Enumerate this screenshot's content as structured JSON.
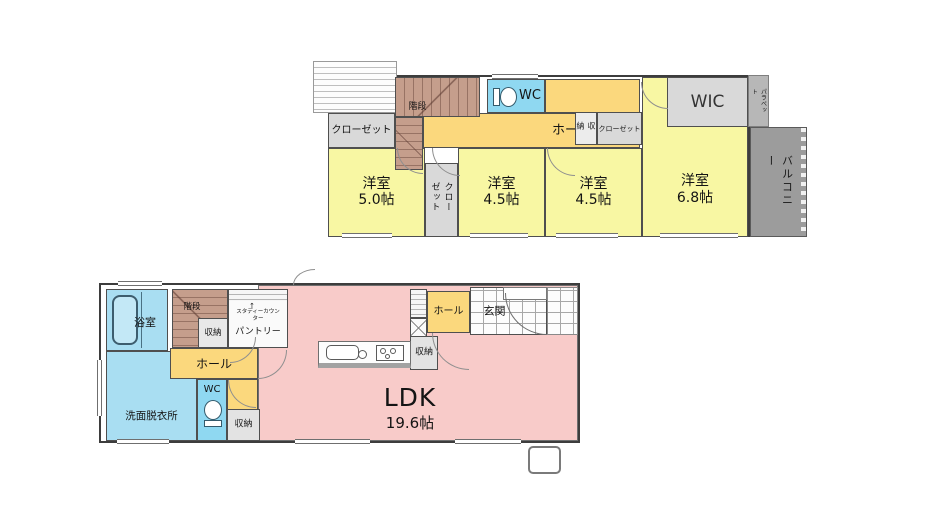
{
  "colors": {
    "room_yellow": "#f8f7a3",
    "hall_orange": "#fbd87d",
    "bath_blue": "#a9def2",
    "wc_blue": "#8fd8f1",
    "stairs_brown": "#c59e8c",
    "closet_gray": "#d9d9d9",
    "parapet_gray": "#b7b7b7",
    "balcony_gray": "#9c9c9c",
    "ldk_pink": "#f8cbc9",
    "wall_dark": "#3d3d3d"
  },
  "floor2": {
    "stairs": "階段",
    "wc": "WC",
    "hall": "ホール",
    "closet_left": "クローゼット",
    "closet_vert": "クローゼット",
    "storage": "収納",
    "closet_mid": "クローゼット",
    "wic": "WIC",
    "parapet": "パラペット",
    "balcony": "バルコニー",
    "rooms": [
      {
        "name": "洋室",
        "size": "5.0帖"
      },
      {
        "name": "洋室",
        "size": "4.5帖"
      },
      {
        "name": "洋室",
        "size": "4.5帖"
      },
      {
        "name": "洋室",
        "size": "6.8帖"
      }
    ]
  },
  "floor1": {
    "bath": "浴室",
    "stairs": "階段",
    "storage_stairs": "収納",
    "pantry": "パントリー",
    "study_counter": "スタディーカウンター",
    "study_counter_arrow": "↑",
    "hall": "ホール",
    "wc": "WC",
    "washroom": "洗面脱衣所",
    "storage_wc": "収納",
    "storage_kitchen": "収納",
    "entrance_hall": "ホール",
    "entrance": "玄関",
    "ldk_name": "LDK",
    "ldk_size": "19.6帖"
  }
}
